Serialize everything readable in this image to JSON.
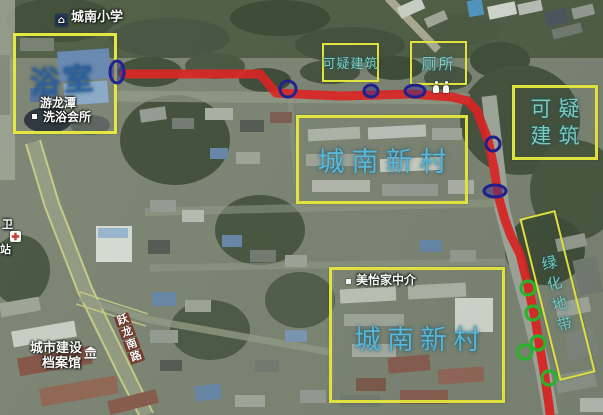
{
  "colors": {
    "annotation_box": "#e7e93c",
    "route": "#df1f1f",
    "blue_marker": "#1b1b8f",
    "green_marker": "#2ab82a",
    "annotation_text_teal": "#7cd2c4",
    "annotation_text_blue": "#57bbe2",
    "bath_note_blue": "rgba(43,97,201,0.60)",
    "map_label_text": "#ffffff"
  },
  "map_labels": {
    "school": "城南小学",
    "bathhouse_line1": "游龙潭",
    "bathhouse_line2": "洗浴会所",
    "agency": "美怡家中介",
    "archives_line1": "城市建设",
    "archives_line2": "档案馆",
    "road_vertical": "跃龙南路",
    "station_char_top": "卫",
    "station_char_bottom": "站"
  },
  "annotations": {
    "bathhouse_note": "浴室",
    "suspicious_top": "可疑建筑",
    "toilet": "厕所",
    "suspicious_right_line1": "可疑",
    "suspicious_right_line2": "建筑",
    "village_center": "城南新村",
    "village_bottom": "城南新村",
    "greenbelt": "绿化地带"
  },
  "overlay": {
    "route_points": [
      [
        124,
        74
      ],
      [
        260,
        74
      ],
      [
        276,
        93
      ],
      [
        340,
        96
      ],
      [
        412,
        94
      ],
      [
        452,
        97
      ],
      [
        468,
        101
      ],
      [
        477,
        111
      ],
      [
        488,
        140
      ],
      [
        494,
        168
      ],
      [
        498,
        195
      ],
      [
        505,
        220
      ],
      [
        511,
        236
      ],
      [
        520,
        254
      ],
      [
        528,
        286
      ],
      [
        535,
        318
      ],
      [
        540,
        348
      ],
      [
        545,
        378
      ],
      [
        549,
        405
      ],
      [
        550,
        414
      ]
    ],
    "blue_markers": [
      {
        "cx": 117,
        "cy": 72,
        "rx": 7,
        "ry": 11,
        "filled": true
      },
      {
        "cx": 288,
        "cy": 89,
        "rx": 8,
        "ry": 8,
        "filled": false
      },
      {
        "cx": 371,
        "cy": 91,
        "rx": 7,
        "ry": 6,
        "filled": true
      },
      {
        "cx": 415,
        "cy": 91,
        "rx": 10,
        "ry": 6,
        "filled": true
      },
      {
        "cx": 493,
        "cy": 144,
        "rx": 7,
        "ry": 7,
        "filled": false
      },
      {
        "cx": 495,
        "cy": 191,
        "rx": 11,
        "ry": 6,
        "filled": true
      }
    ],
    "green_markers": [
      [
        528,
        288
      ],
      [
        533,
        313
      ],
      [
        538,
        343
      ],
      [
        525,
        352
      ],
      [
        549,
        378
      ]
    ],
    "green_marker_radius": 7
  }
}
